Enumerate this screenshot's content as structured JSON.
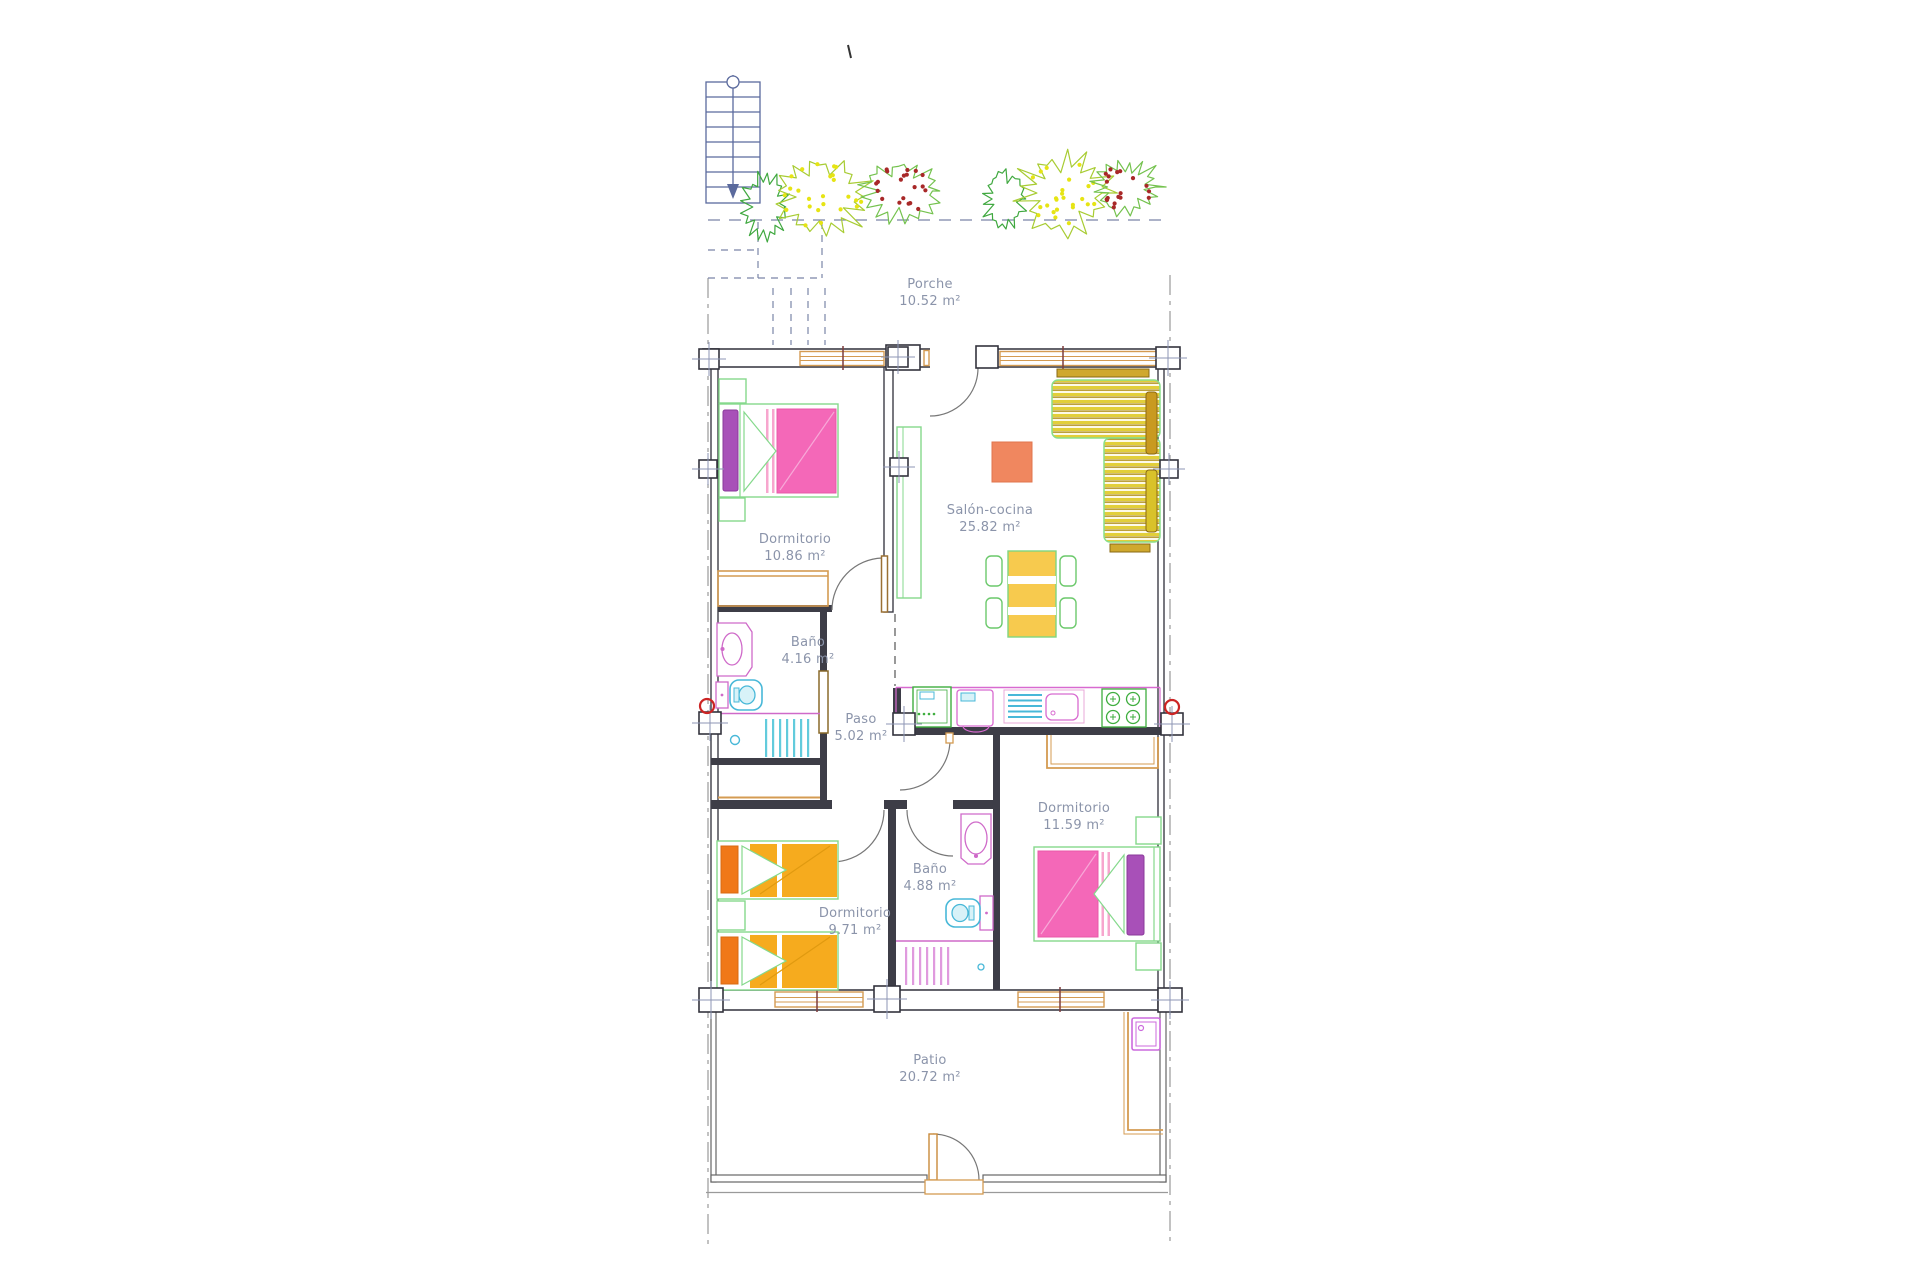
{
  "plan": {
    "rooms": [
      {
        "name": "Porche",
        "area": "10.52 m²"
      },
      {
        "name": "Dormitorio",
        "area": "10.86 m²"
      },
      {
        "name": "Salón-cocina",
        "area": "25.82 m²"
      },
      {
        "name": "Baño",
        "area": "4.16 m²"
      },
      {
        "name": "Paso",
        "area": "5.02 m²"
      },
      {
        "name": "Dormitorio",
        "area": "11.59 m²"
      },
      {
        "name": "Baño",
        "area": "4.88 m²"
      },
      {
        "name": "Dormitorio",
        "area": "9.71 m²"
      },
      {
        "name": "Patio",
        "area": "20.72 m²"
      }
    ],
    "colors": {
      "wall": "#3d3d47",
      "label": "#8b94aa",
      "window_frame": "#d49b52",
      "furniture_outline_green": "#85d98c",
      "bed_pink": "#f468b8",
      "pillow_purple": "#a850b8",
      "bed_orange": "#f6ab1e",
      "pillow_orange": "#f07818",
      "sofa_yellow": "#e2cf3a",
      "table_yellow": "#f7ca4e",
      "coffee_table_salmon": "#f0875f",
      "sanitary_magenta": "#cf6ac9",
      "sanitary_cyan": "#62cbdc",
      "plumbing_mark_red": "#cc2525",
      "stairs_blue": "#5b6a9d",
      "bush_green": "#3fa83f",
      "bush_yellow_dots": "#e6e414",
      "bush_red_dots": "#a82828"
    }
  }
}
